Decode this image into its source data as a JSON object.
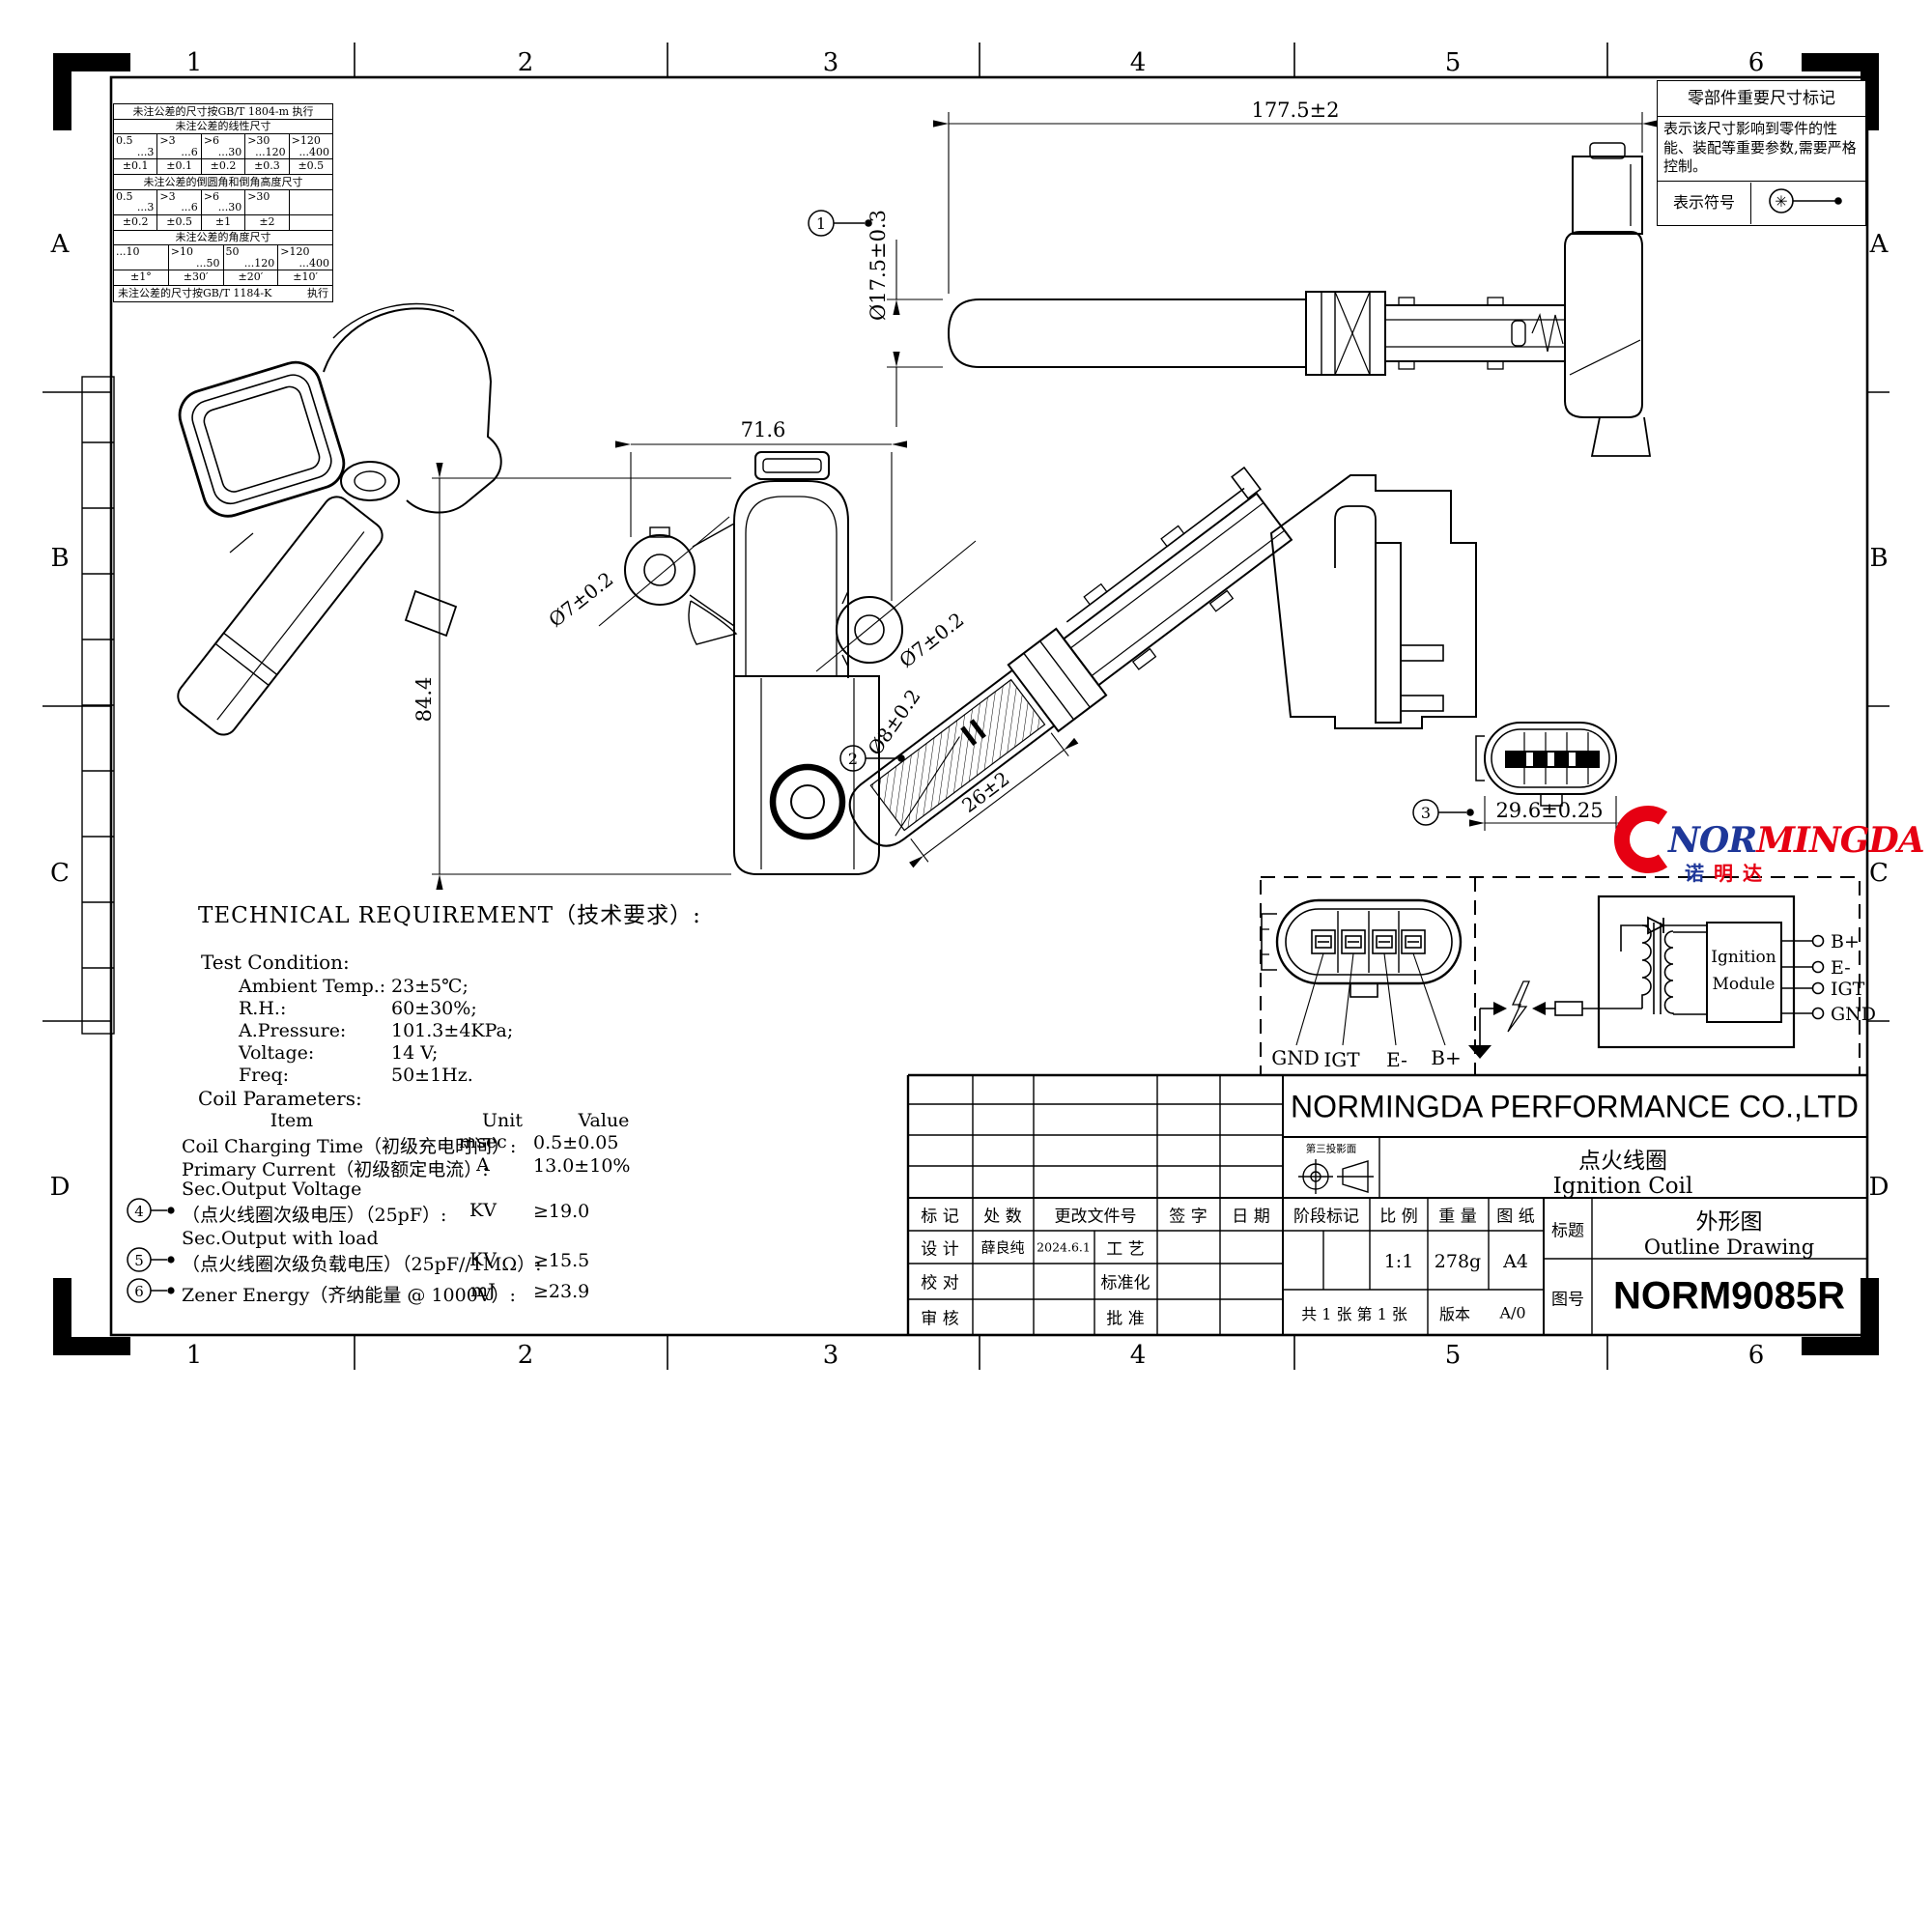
{
  "sheet": {
    "zones_h": [
      "1",
      "2",
      "3",
      "4",
      "5",
      "6"
    ],
    "zones_v": [
      "A",
      "B",
      "C",
      "D"
    ]
  },
  "tolerance_table": {
    "rule_top": "未注公差的尺寸按GB/T 1804-m 执行",
    "linear_title": "未注公差的线性尺寸",
    "linear_ranges": [
      {
        "a": "0.5",
        "b": "...3"
      },
      {
        "a": ">3",
        "b": "...6"
      },
      {
        "a": ">6",
        "b": "...30"
      },
      {
        "a": ">30",
        "b": "...120"
      },
      {
        "a": ">120",
        "b": "...400"
      }
    ],
    "linear_tols": [
      "±0.1",
      "±0.1",
      "±0.2",
      "±0.3",
      "±0.5"
    ],
    "chamfer_title": "未注公差的倒圆角和倒角高度尺寸",
    "chamfer_ranges": [
      {
        "a": "0.5",
        "b": "...3"
      },
      {
        "a": ">3",
        "b": "...6"
      },
      {
        "a": ">6",
        "b": "...30"
      },
      {
        "a": ">30",
        "b": ""
      },
      {
        "a": "",
        "b": ""
      }
    ],
    "chamfer_tols": [
      "±0.2",
      "±0.5",
      "±1",
      "±2",
      ""
    ],
    "angle_title": "未注公差的角度尺寸",
    "angle_ranges": [
      {
        "a": "...10",
        "b": ""
      },
      {
        "a": ">10",
        "b": "...50"
      },
      {
        "a": "50",
        "b": "...120"
      },
      {
        "a": ">120",
        "b": "...400"
      }
    ],
    "angle_tols": [
      "±1°",
      "±30′",
      "±20′",
      "±10′"
    ],
    "rule_bottom": "未注公差的尺寸按GB/T 1184-K",
    "rule_bottom_exec": "执行"
  },
  "important_note": {
    "title": "零部件重要尺寸标记",
    "body": "表示该尺寸影响到零件的性能、装配等重要参数,需要严格控制。",
    "symbol_label": "表示符号",
    "symbol_glyph": "✳"
  },
  "dimensions": {
    "length": "177.5±2",
    "boot_dia": "Ø17.5±0.3",
    "width": "71.6",
    "height": "84.4",
    "hole_left": "Ø7±0.2",
    "hole_right": "Ø7±0.2",
    "tip_dia": "Ø8±0.2",
    "tip_len": "26±2",
    "conn_width": "29.6±0.25"
  },
  "balloons": {
    "b1": "1",
    "b2": "2",
    "b3": "3",
    "b4": "4",
    "b5": "5",
    "b6": "6"
  },
  "tech_req": {
    "heading": "TECHNICAL  REQUIREMENT（技术要求）:",
    "test_condition": "Test Condition:",
    "conditions": [
      {
        "label": "Ambient Temp.:",
        "value": "23±5℃;"
      },
      {
        "label": "R.H.:",
        "value": "60±30%;"
      },
      {
        "label": "A.Pressure:",
        "value": "101.3±4KPa;"
      },
      {
        "label": "Voltage:",
        "value": "14 V;"
      },
      {
        "label": "Freq:",
        "value": "50±1Hz."
      }
    ],
    "coil_params": "Coil Parameters:",
    "col_item": "Item",
    "col_unit": "Unit",
    "col_value": "Value",
    "rows": [
      {
        "pre": "",
        "item": "Coil Charging Time（初级充电时间）:",
        "unit": "msec",
        "value": "0.5±0.05"
      },
      {
        "pre": "",
        "item": "Primary Current（初级额定电流）:",
        "unit": "A",
        "value": "13.0±10%"
      },
      {
        "pre": "Sec.Output Voltage",
        "item": "（点火线圈次级电压）（25pF）:",
        "unit": "KV",
        "value": "≥19.0"
      },
      {
        "pre": "Sec.Output with load",
        "item": "（点火线圈次级负载电压）（25pF//1MΩ）:",
        "unit": "KV",
        "value": "≥15.5"
      },
      {
        "pre": "",
        "item": "Zener Energy（齐纳能量 @ 1000V）:",
        "unit": "mJ",
        "value": "≥23.9"
      }
    ]
  },
  "pinout": {
    "pins": [
      "GND",
      "IGT",
      "E-",
      "B+"
    ]
  },
  "circuit": {
    "module_line1": "Ignition",
    "module_line2": "Module",
    "terminals": [
      "B+",
      "E-",
      "IGT",
      "GND"
    ]
  },
  "logo": {
    "prefix": "NOR",
    "suffix": "MINGDA",
    "cn1": "诺",
    "cn2": "明",
    "cn3": "达",
    "red": "#e60012",
    "blue": "#1e3799"
  },
  "title_block": {
    "company": "NORMINGDA PERFORMANCE CO.,LTD",
    "part_cn": "点火线圈",
    "part_en": "Ignition Coil",
    "projection_label": "第三投影面",
    "rev_c1": "标  记",
    "rev_c2": "处  数",
    "rev_c3": "更改文件号",
    "rev_c4": "签  字",
    "rev_c5": "日  期",
    "design_label": "设  计",
    "designer": "薛良纯",
    "date": "2024.6.1",
    "process_label": "工  艺",
    "check_label": "校  对",
    "standard_label": "标准化",
    "audit_label": "审  核",
    "approve_label": "批  准",
    "stage_label": "阶段标记",
    "scale_label": "比  例",
    "weight_label": "重  量",
    "paper_label": "图  纸",
    "scale": "1:1",
    "weight": "278g",
    "paper": "A4",
    "sheet_info": "共 1 张 第 1 张",
    "version_label": "版本",
    "version": "A/0",
    "title_label": "标题",
    "title_cn": "外形图",
    "title_en": "Outline Drawing",
    "no_label": "图号",
    "drawing_no": "NORM9085R"
  }
}
